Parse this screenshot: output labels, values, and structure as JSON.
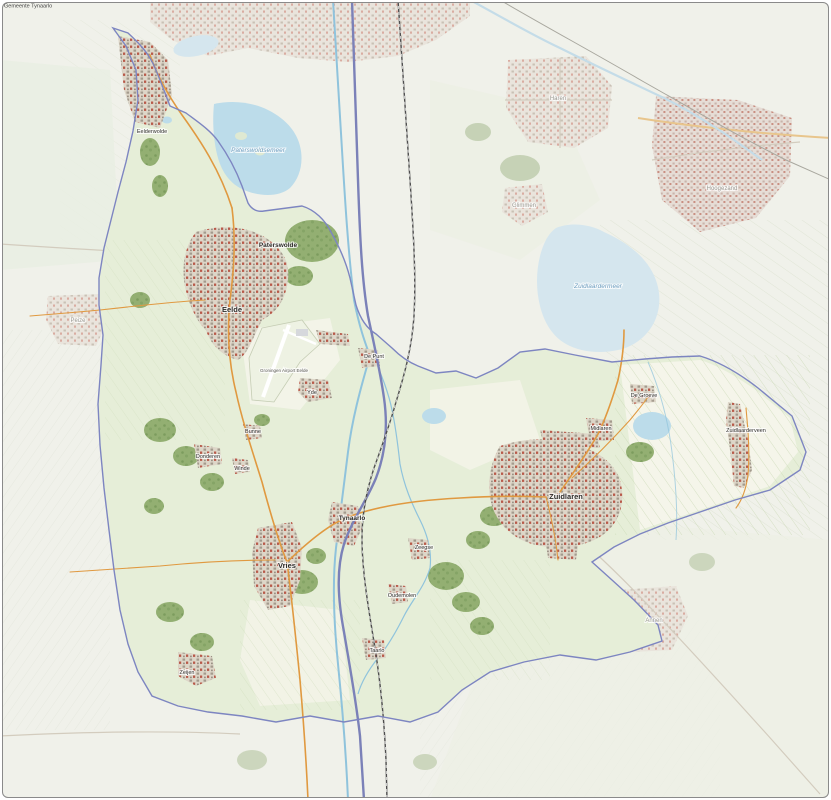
{
  "map": {
    "title": "Gemeente Tynaarlo",
    "municipality": "Tynaarlo",
    "labels": [
      {
        "name": "Eelderwolde",
        "x": 152,
        "y": 133,
        "cls": "hamlet"
      },
      {
        "name": "Paterswolde",
        "x": 278,
        "y": 247,
        "cls": "town"
      },
      {
        "name": "Eelde",
        "x": 232,
        "y": 312,
        "cls": "town-large"
      },
      {
        "name": "Yde",
        "x": 312,
        "y": 394,
        "cls": "hamlet"
      },
      {
        "name": "De Punt",
        "x": 374,
        "y": 358,
        "cls": "hamlet"
      },
      {
        "name": "Bunne",
        "x": 253,
        "y": 433,
        "cls": "hamlet"
      },
      {
        "name": "Winde",
        "x": 242,
        "y": 470,
        "cls": "hamlet"
      },
      {
        "name": "Donderen",
        "x": 208,
        "y": 458,
        "cls": "hamlet"
      },
      {
        "name": "Vries",
        "x": 287,
        "y": 568,
        "cls": "town-large"
      },
      {
        "name": "Tynaarlo",
        "x": 352,
        "y": 520,
        "cls": "town"
      },
      {
        "name": "Zeegse",
        "x": 424,
        "y": 549,
        "cls": "hamlet"
      },
      {
        "name": "Oudemolen",
        "x": 402,
        "y": 597,
        "cls": "hamlet"
      },
      {
        "name": "Taarlo",
        "x": 377,
        "y": 652,
        "cls": "hamlet"
      },
      {
        "name": "Zeijen",
        "x": 187,
        "y": 674,
        "cls": "hamlet"
      },
      {
        "name": "Zuidlaren",
        "x": 566,
        "y": 499,
        "cls": "town-large"
      },
      {
        "name": "Midlaren",
        "x": 601,
        "y": 430,
        "cls": "hamlet"
      },
      {
        "name": "De Groeve",
        "x": 644,
        "y": 397,
        "cls": "hamlet"
      },
      {
        "name": "Zuidlaarderveen",
        "x": 746,
        "y": 432,
        "cls": "hamlet"
      },
      {
        "name": "Groningen Airport Eelde",
        "x": 284,
        "y": 372,
        "cls": "tiny"
      },
      {
        "name": "Haren",
        "x": 558,
        "y": 100,
        "cls": "outside"
      },
      {
        "name": "Glimmen",
        "x": 524,
        "y": 207,
        "cls": "outside"
      },
      {
        "name": "Hoogezand",
        "x": 722,
        "y": 190,
        "cls": "outside"
      },
      {
        "name": "Peize",
        "x": 78,
        "y": 322,
        "cls": "outside"
      },
      {
        "name": "Annen",
        "x": 654,
        "y": 622,
        "cls": "outside"
      },
      {
        "name": "Paterswoldsemeer",
        "x": 258,
        "y": 152,
        "cls": "water"
      },
      {
        "name": "Zuidlaardermeer",
        "x": 598,
        "y": 288,
        "cls": "water"
      }
    ],
    "colors": {
      "outside_base": "#f0f1ea",
      "outside_water": "#d5e6ee",
      "municipality_fill": "#e6eed8",
      "municipality_border": "#7d85c1",
      "water": "#bcdcea",
      "stream": "#8fc3dc",
      "woods": "#93af72",
      "field": "#f6f5ec",
      "road_main": "#e09940",
      "motorway": "#7b81b8",
      "railway": "#4d4d4d",
      "urban_base": "#ddd6c8",
      "urban_roof": "#b85a4a",
      "outside_urban": "#e9e4dc",
      "label_town": "#2e2d2a",
      "label_outside": "#9b9b93",
      "label_water": "#6f9fc0",
      "frame_border": "#8a8a8a"
    }
  }
}
